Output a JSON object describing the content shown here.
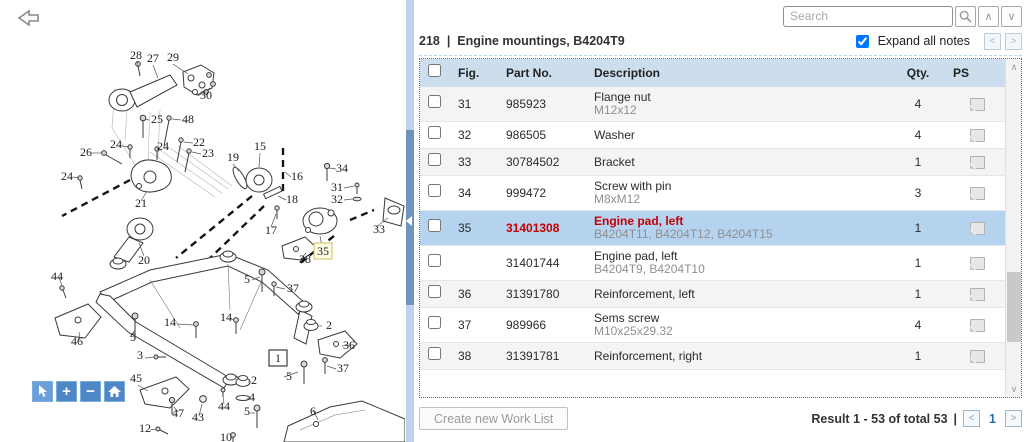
{
  "colors": {
    "accent_blue": "#4f86c6",
    "selected_row": "#b5d3ef",
    "header_row": "#ccdeee",
    "alert_red": "#c40000",
    "splitter_track": "#bcd3ea",
    "splitter_thumb": "#6e94ba"
  },
  "search": {
    "placeholder": "Search"
  },
  "icons": {
    "search_icon": "magnifier",
    "up_glyph": "∧",
    "down_glyph": "∨",
    "prev_glyph": "<",
    "next_glyph": ">",
    "zoom_in_glyph": "+",
    "zoom_out_glyph": "−"
  },
  "header": {
    "section_number": "218",
    "separator": "|",
    "title": "Engine mountings, B4204T9",
    "expand_notes_label": "Expand all notes",
    "expand_notes_checked": true
  },
  "table": {
    "columns": {
      "fig": "Fig.",
      "part": "Part No.",
      "desc": "Description",
      "qty": "Qty.",
      "ps": "PS"
    },
    "rows": [
      {
        "fig": "31",
        "part": "985923",
        "desc": "Flange nut",
        "note": "M12x12",
        "qty": "4",
        "selected": false
      },
      {
        "fig": "32",
        "part": "986505",
        "desc": "Washer",
        "note": "",
        "qty": "4",
        "selected": false
      },
      {
        "fig": "33",
        "part": "30784502",
        "desc": "Bracket",
        "note": "",
        "qty": "1",
        "selected": false
      },
      {
        "fig": "34",
        "part": "999472",
        "desc": "Screw with pin",
        "note": "M8xM12",
        "qty": "3",
        "selected": false
      },
      {
        "fig": "35",
        "part": "31401308",
        "desc": "Engine pad, left",
        "note": "B4204T11, B4204T12, B4204T15",
        "qty": "1",
        "selected": true
      },
      {
        "fig": "",
        "part": "31401744",
        "desc": "Engine pad, left",
        "note": "B4204T9, B4204T10",
        "qty": "1",
        "selected": false
      },
      {
        "fig": "36",
        "part": "31391780",
        "desc": "Reinforcement, left",
        "note": "",
        "qty": "1",
        "selected": false
      },
      {
        "fig": "37",
        "part": "989966",
        "desc": "Sems screw",
        "note": "M10x25x29.32",
        "qty": "4",
        "selected": false
      },
      {
        "fig": "38",
        "part": "31391781",
        "desc": "Reinforcement, right",
        "note": "",
        "qty": "1",
        "selected": false
      }
    ]
  },
  "footer": {
    "create_worklist_label": "Create new Work List",
    "result_text": "Result 1 - 53 of total 53",
    "pipe": "|",
    "page": "1"
  },
  "diagram": {
    "highlighted_figure": "35",
    "labels": [
      {
        "t": "28",
        "x": 136,
        "y": 59
      },
      {
        "t": "27",
        "x": 153,
        "y": 62
      },
      {
        "t": "29",
        "x": 173,
        "y": 61
      },
      {
        "t": "30",
        "x": 206,
        "y": 99
      },
      {
        "t": "25",
        "x": 157,
        "y": 123
      },
      {
        "t": "48",
        "x": 188,
        "y": 123
      },
      {
        "t": "22",
        "x": 199,
        "y": 146
      },
      {
        "t": "23",
        "x": 208,
        "y": 157
      },
      {
        "t": "24",
        "x": 116,
        "y": 148
      },
      {
        "t": "24",
        "x": 163,
        "y": 150
      },
      {
        "t": "26",
        "x": 86,
        "y": 156
      },
      {
        "t": "24",
        "x": 67,
        "y": 180
      },
      {
        "t": "21",
        "x": 141,
        "y": 207
      },
      {
        "t": "19",
        "x": 233,
        "y": 161
      },
      {
        "t": "15",
        "x": 260,
        "y": 150
      },
      {
        "t": "16",
        "x": 297,
        "y": 180
      },
      {
        "t": "18",
        "x": 292,
        "y": 203
      },
      {
        "t": "17",
        "x": 271,
        "y": 234
      },
      {
        "t": "34",
        "x": 342,
        "y": 172
      },
      {
        "t": "31",
        "x": 337,
        "y": 191
      },
      {
        "t": "32",
        "x": 337,
        "y": 203
      },
      {
        "t": "33",
        "x": 379,
        "y": 233
      },
      {
        "t": "35",
        "x": 323,
        "y": 255,
        "highlight": true
      },
      {
        "t": "38",
        "x": 305,
        "y": 263
      },
      {
        "t": "20",
        "x": 144,
        "y": 264
      },
      {
        "t": "44",
        "x": 57,
        "y": 280
      },
      {
        "t": "5",
        "x": 247,
        "y": 283
      },
      {
        "t": "37",
        "x": 293,
        "y": 292
      },
      {
        "t": "14",
        "x": 170,
        "y": 326
      },
      {
        "t": "14",
        "x": 226,
        "y": 321
      },
      {
        "t": "2",
        "x": 329,
        "y": 329
      },
      {
        "t": "46",
        "x": 77,
        "y": 345
      },
      {
        "t": "5",
        "x": 133,
        "y": 341
      },
      {
        "t": "36",
        "x": 349,
        "y": 349
      },
      {
        "t": "3",
        "x": 140,
        "y": 359
      },
      {
        "t": "1",
        "x": 278,
        "y": 362,
        "boxed": true
      },
      {
        "t": "37",
        "x": 343,
        "y": 372
      },
      {
        "t": "5",
        "x": 289,
        "y": 380
      },
      {
        "t": "45",
        "x": 136,
        "y": 382
      },
      {
        "t": "2",
        "x": 254,
        "y": 384
      },
      {
        "t": "4",
        "x": 252,
        "y": 401
      },
      {
        "t": "44",
        "x": 224,
        "y": 410
      },
      {
        "t": "5",
        "x": 247,
        "y": 415
      },
      {
        "t": "47",
        "x": 178,
        "y": 417
      },
      {
        "t": "43",
        "x": 198,
        "y": 421
      },
      {
        "t": "6",
        "x": 313,
        "y": 415
      },
      {
        "t": "12",
        "x": 145,
        "y": 432
      },
      {
        "t": "10",
        "x": 226,
        "y": 441
      }
    ]
  }
}
